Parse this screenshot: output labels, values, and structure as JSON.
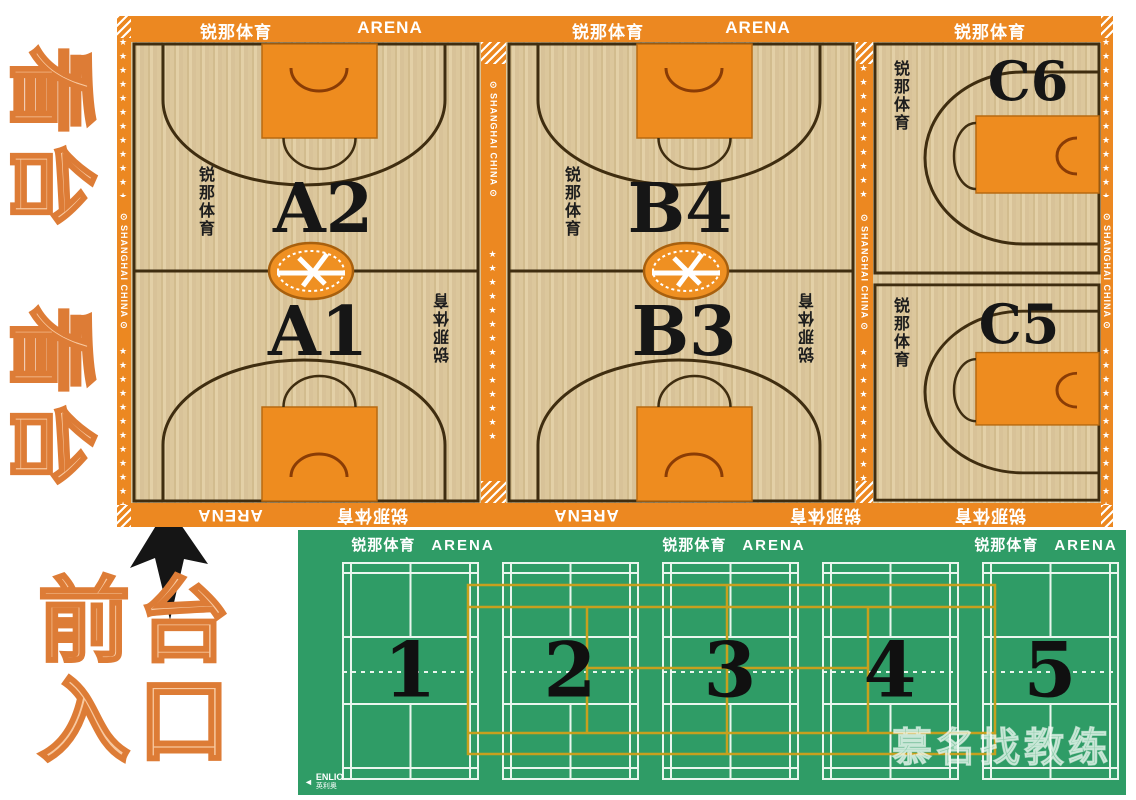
{
  "stands": {
    "label": "看台"
  },
  "entrance": {
    "line1": "前台",
    "line2": "入口"
  },
  "brand": {
    "cn": "锐那体育",
    "arena": "ARENA",
    "shanghai": "⊙ SHANGHAI CHINA ⊙",
    "stars": "★★★★★★★★★★★★★★"
  },
  "basketball": {
    "courts": [
      {
        "id": "A",
        "top_label": "A2",
        "bottom_label": "A1"
      },
      {
        "id": "B",
        "top_label": "B4",
        "bottom_label": "B3"
      },
      {
        "id": "C",
        "top_label": "C6",
        "bottom_label": "C5"
      }
    ]
  },
  "badminton": {
    "courts": [
      "1",
      "2",
      "3",
      "4",
      "5"
    ]
  },
  "footer_logo": {
    "name": "ENLIO",
    "cn": "英利奥",
    "arrow": "◄"
  },
  "watermark": {
    "text": "慕名找教练"
  },
  "colors": {
    "orange_border": "#ec8821",
    "orange_key": "#ee8c1f",
    "wood": "#d9c69c",
    "court_line": "#3f2d10",
    "green_floor": "#2f9c66",
    "badminton_line": "#eaf6ee",
    "overlay_yellow": "#c7a01e",
    "stands_fill": "#f8c9a0",
    "stands_stroke": "#dd7c36",
    "label_black": "#161616",
    "white": "#ffffff"
  }
}
